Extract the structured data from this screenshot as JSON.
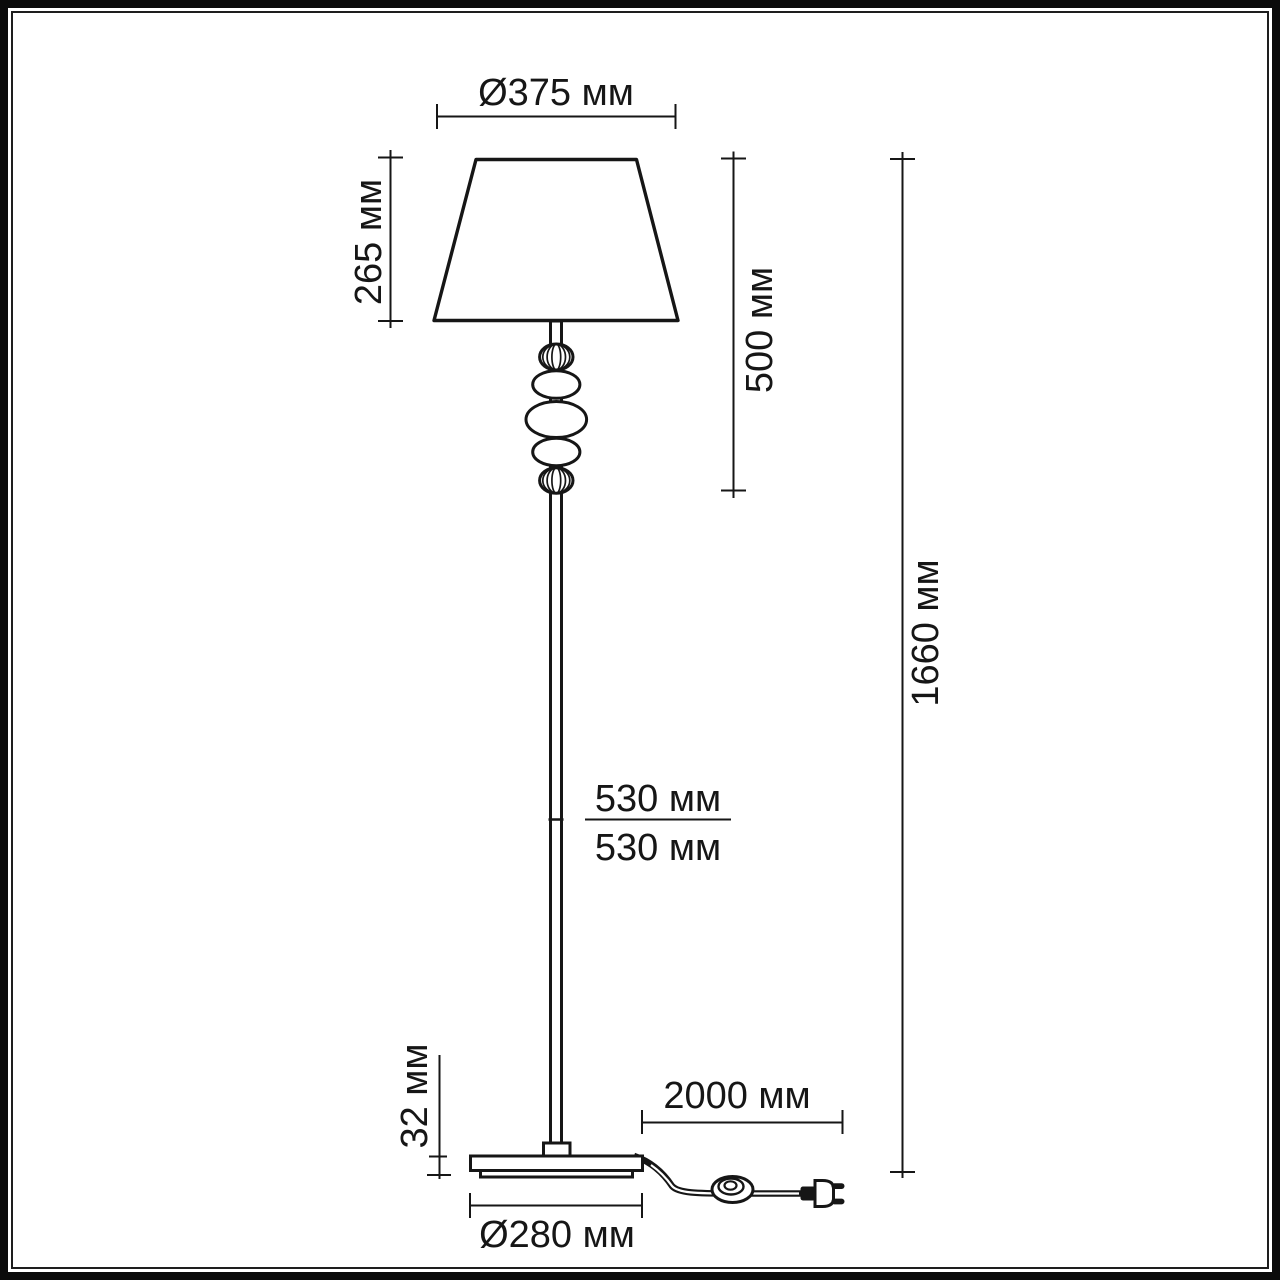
{
  "drawing": {
    "background": "#ffffff",
    "line_color": "#161616",
    "product": "floor-lamp-dimension-diagram",
    "labels": {
      "shade_diameter": "Ø375 мм",
      "shade_height": "265 мм",
      "shade_top_to_pole": "500 мм",
      "total_height": "1660 мм",
      "pole_upper_segment": "530 мм",
      "pole_lower_segment": "530 мм",
      "base_thickness": "32 мм",
      "cable_length": "2000 мм",
      "base_diameter": "Ø280 мм"
    }
  }
}
